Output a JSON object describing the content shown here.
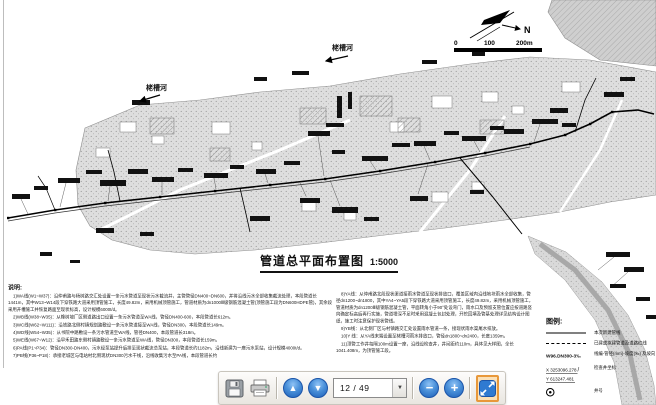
{
  "toolbar": {
    "page_display": "12 / 49",
    "page_current": "12",
    "page_total": "49",
    "page_up_glyph": "▲",
    "page_down_glyph": "▼",
    "dropdown_glyph": "▼",
    "zoom_out_glyph": "−",
    "zoom_in_glyph": "+",
    "icons": [
      "save-icon",
      "print-icon",
      "page-up-icon",
      "page-down-icon",
      "page-select",
      "zoom-out-icon",
      "zoom-in-icon",
      "fit-page-icon"
    ]
  },
  "drawing": {
    "title": "管道总平面布置图",
    "scale": "1:5000",
    "north_label": "N",
    "scale_bar": {
      "tick0": "0",
      "tick1": "100",
      "tick2": "200m"
    },
    "river_label": "栳槽河",
    "notes": {
      "header": "说明:",
      "left": [
        "1)WA线(W1~W37)：沿仲甫路与杨树路交汇处设置一条污水管道至现状污水截流井，主管管径DN400~DN600，并将沿线污水全部收集截流处理，本段管道长1441m，其中W13~W14段下穿铁路大道采用顶管施工，长度49.82m，采用机械顶管施工，管道材质为dn1000Ⅲ级钢筋混凝土管(顶管施工段为DN600HDPE管)，其余段采用开槽施工并恢复路面至现状标高，设计规模6000t/d。",
        "2)WB线(W38~W35)：从橡树坡厂区侧道路出口设置一条污水管道至WA线，管径DN400-600，本段管道长612m。",
        "3)WC线(W62~W111)：沿铁路北侧村镇规划路敷设一条污水管道接至WA线，管径DN300，本段管道长149m。",
        "4)WD线(W54~W35)：从书院中路敷设一条污水管道至WA线，管径DN400，本段管道长318m。",
        "5)WE线(W67~W12)：沿早禾田路东侧村镇路敷设一条污水管道至WA线，管径DN300，本段管道长159m。",
        "6)PA线(P1~P34)：管径DN300-DN400，污水经泵站提升后排至现状截流总泵站，本段管道长约1182m，沿线新建为一座污水泵站，设计规模4000t/d。",
        "7)PB线(P36~P18)：承接老城区与电站村北侧现状DN300污水干线，沿线收集污水至PA线，本段管道长约"
      ],
      "right": [
        "8)YA线：从仲甫路北段现状渠道接雨水管道至现状排放口，覆盖区域内沿线地块雨水全部收集，管径dn1200~dn1800，其中YA4~YA5段下穿铁路大道采用顶管施工，长度49.82m，采用机械顶管施工，管道材质为dn1200Ⅲ级钢筋混凝土管，平面转角小于90°处设弯门，雨水口及预留支管位置应按道路竖向确定标高后再行实施，管道埋深不足时采用混凝土包封处理，开挖回填及管基处理详见结构设计图纸，施工时注意保护现状管线。",
        "9)YB线：从北侧厂区与村镇路交汇处设置雨水管道一条，接现状雨水渠尾水排放。",
        "10)Y 线：从YA线末端设置至栳槽河雨水排放口，管径dn1800~dn2400，长度1359m。",
        "11)顶管工作井每隔100m设置一座，沿线设检查井，井间距约110m，具体见大样图，全长1041.408m，为顶管施工段。"
      ]
    },
    "legend": {
      "header": "图例:",
      "items": [
        {
          "symbol": "solid-line",
          "label": "本次新建管线"
        },
        {
          "symbol": "dashed-line",
          "label": "已建或拟建管道及道路红线"
        },
        {
          "symbol": "pipe-label",
          "text": "W96.DN300-3‰",
          "label": "线编-管径(mm)-坡度(‰) 及坡向"
        },
        {
          "symbol": "coordinates",
          "x": "X 3253096.278",
          "y": "Y 613247.481",
          "label": "检查井坐标"
        },
        {
          "symbol": "manhole-circle",
          "label": "井号"
        }
      ]
    }
  }
}
